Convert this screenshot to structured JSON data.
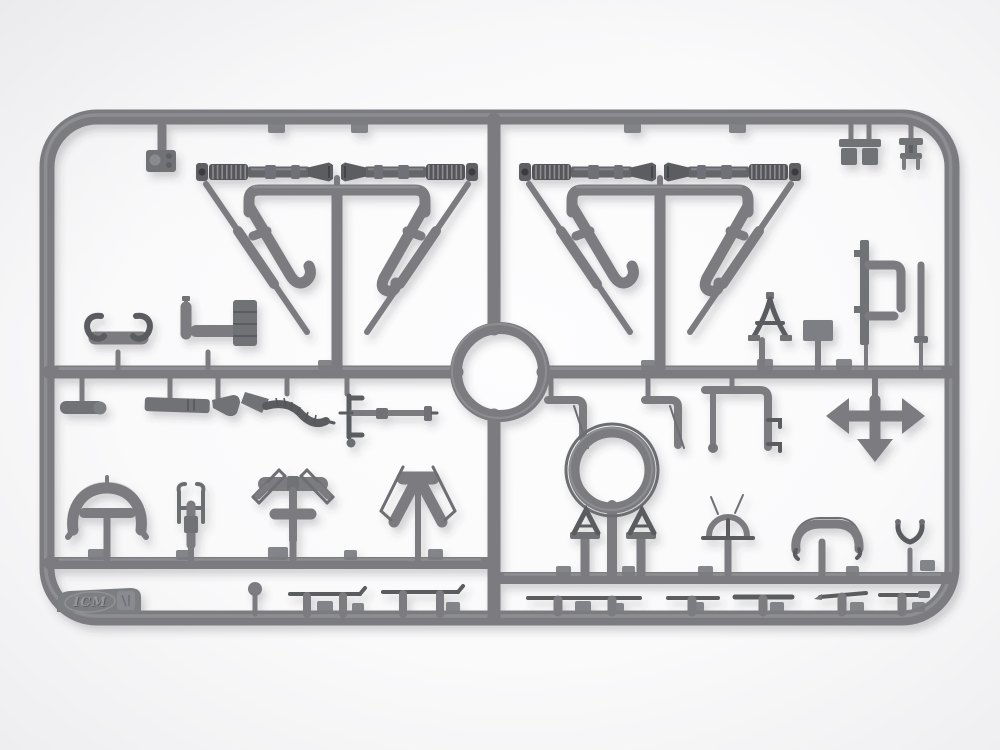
{
  "meta": {
    "description": "Photograph of a grey injection-molded plastic model-kit sprue (parts tree) with machine-gun mount and fitting parts, on a white background"
  },
  "sprue": {
    "logo_text": "ICM",
    "material": "grey styrene plastic",
    "part_groups": [
      "gun-barrel",
      "gun-mount-frame",
      "support-strut",
      "center-ring",
      "ring-sight-assembly",
      "trestle-bracket",
      "dome-part",
      "handlebar-part",
      "fork-part",
      "arrow-cross-part",
      "tie-rod",
      "umbrella-guard",
      "tee-cradle",
      "a-frame",
      "hose-funnel",
      "axle-bracket"
    ]
  },
  "colors": {
    "tube": "#7b7c80",
    "tube_dark": "#5a5b5f",
    "tube_hi": "#9ea0a4",
    "part": "#717276",
    "bg_center": "#fdfdfe",
    "bg_edge": "#eeeef0"
  }
}
